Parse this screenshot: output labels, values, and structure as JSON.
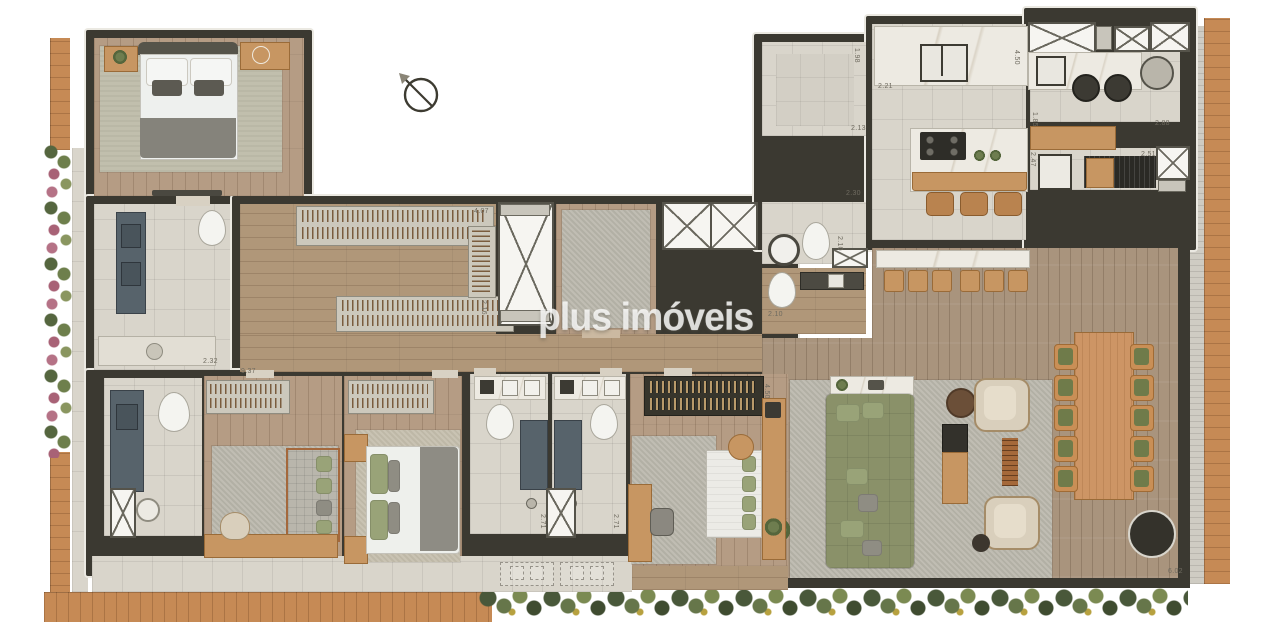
{
  "watermark": {
    "text": "plus imóveis"
  },
  "compass": {
    "type": "north-indicator"
  },
  "palette": {
    "wall": "#3b3931",
    "wood_frame": "#c68a55",
    "floor_wood": "#b59c84",
    "terrace_wood": "#a9947d",
    "floor_tile": "#d9d5cb",
    "rug": "#bcb9ae",
    "sofa_green": "#8a9169",
    "marble": "#edeae2",
    "plant_green": "#6e7d4f",
    "garden_pink": "#a86276"
  },
  "dining": {
    "chairs_per_side": 5,
    "cushion_color": "#6f7b4a"
  },
  "dimensions": [
    {
      "t": "4.07",
      "x": 474,
      "y": 208,
      "r": 0
    },
    {
      "t": "2.16",
      "x": 487,
      "y": 300,
      "r": 90
    },
    {
      "t": "9.37",
      "x": 241,
      "y": 368,
      "r": 0
    },
    {
      "t": "2.32",
      "x": 203,
      "y": 358,
      "r": 0
    },
    {
      "t": "2.30",
      "x": 846,
      "y": 190,
      "r": 0
    },
    {
      "t": "2.13",
      "x": 851,
      "y": 125,
      "r": 0
    },
    {
      "t": "1.98",
      "x": 860,
      "y": 48,
      "r": 90
    },
    {
      "t": "2.21",
      "x": 878,
      "y": 83,
      "r": 0
    },
    {
      "t": "4.50",
      "x": 1020,
      "y": 50,
      "r": 90
    },
    {
      "t": "1.85",
      "x": 1038,
      "y": 112,
      "r": 90
    },
    {
      "t": "2.88",
      "x": 1155,
      "y": 120,
      "r": 0
    },
    {
      "t": "2.51",
      "x": 1141,
      "y": 151,
      "r": 0
    },
    {
      "t": "2.47",
      "x": 1036,
      "y": 152,
      "r": 90
    },
    {
      "t": "2.10",
      "x": 843,
      "y": 236,
      "r": 90
    },
    {
      "t": "2.10",
      "x": 768,
      "y": 311,
      "r": 0
    },
    {
      "t": "2.71",
      "x": 546,
      "y": 514,
      "r": 90
    },
    {
      "t": "2.71",
      "x": 619,
      "y": 514,
      "r": 90
    },
    {
      "t": "4.50",
      "x": 770,
      "y": 384,
      "r": 90
    },
    {
      "t": "6.02",
      "x": 1168,
      "y": 568,
      "r": 0
    }
  ]
}
